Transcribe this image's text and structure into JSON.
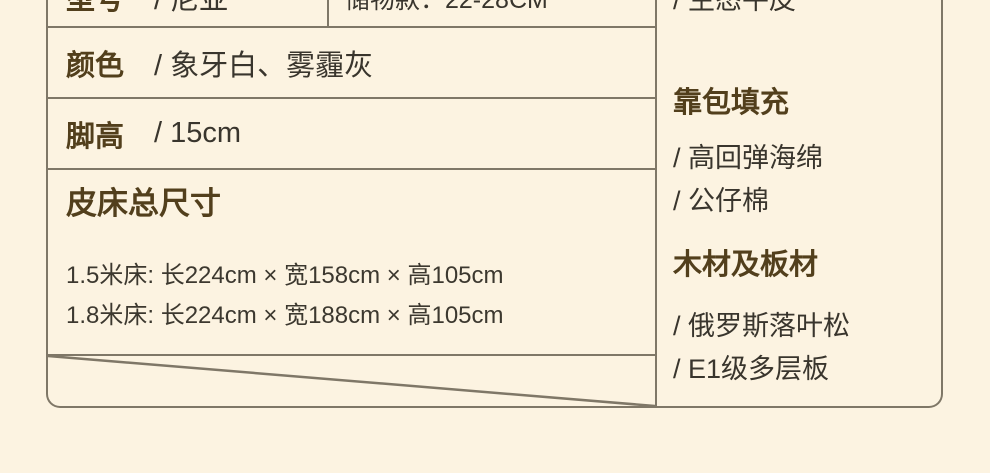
{
  "product_spec": {
    "row_model": {
      "label": "型号",
      "value": "/ 尼亚",
      "storage_note": "储物款：22-28CM"
    },
    "row_color": {
      "label": "颜色",
      "value": "/ 象牙白、雾霾灰"
    },
    "row_leg": {
      "label": "脚高",
      "value": "/ 15cm"
    },
    "dimensions": {
      "heading": "皮床总尺寸",
      "line1": "1.5米床: 长224cm × 宽158cm × 高105cm",
      "line2": "1.8米床: 长224cm × 宽188cm × 高105cm"
    },
    "right_column": {
      "top_item": "/ 生态牛皮",
      "cushion": {
        "heading": "靠包填充",
        "item1": "/ 高回弹海绵",
        "item2": "/ 公仔棉"
      },
      "wood": {
        "heading": "木材及板材",
        "item1": "/ 俄罗斯落叶松",
        "item2": "/ E1级多层板"
      }
    },
    "colors": {
      "background": "#fcf3e1",
      "border": "#7f7767",
      "heading_brown": "#523f1c",
      "text_dark": "#39352d"
    }
  }
}
